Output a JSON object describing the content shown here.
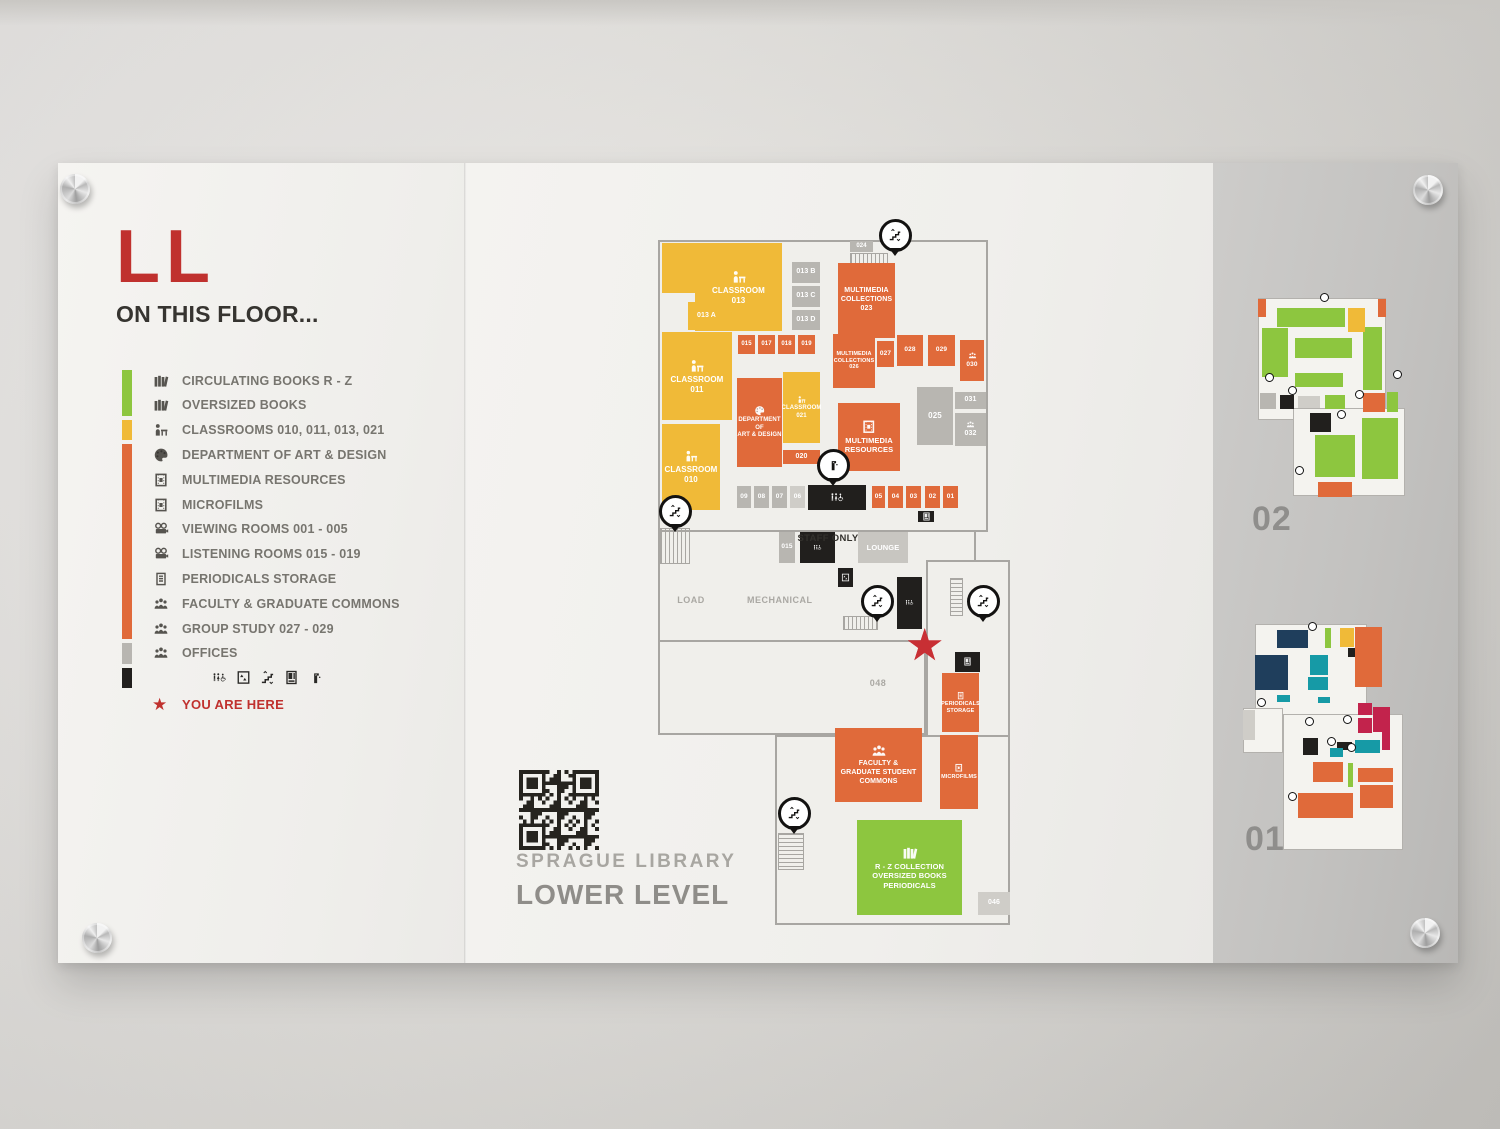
{
  "sign": {
    "floor_code": "LL",
    "heading": "ON THIS FLOOR...",
    "library_name": "SPRAGUE LIBRARY",
    "level_name": "LOWER LEVEL",
    "you_are_here": "YOU ARE HERE"
  },
  "colors": {
    "red": "#c0312e",
    "green": "#8dc63f",
    "yellow": "#f0ba38",
    "orange": "#e06a3a",
    "gray_room": "#b8b6b1",
    "gray_light": "#cfcdc8",
    "lounge": "#c8c6c1",
    "black": "#211f1d",
    "navy": "#1f3e5c",
    "teal": "#169aa6",
    "crimson": "#c2234c",
    "legend_green_rows": [
      0,
      1
    ],
    "legend_yellow_rows": [
      2,
      2
    ],
    "legend_orange_rows": [
      3,
      10
    ],
    "legend_gray_rows": [
      11,
      11
    ],
    "legend_black_rows": [
      12,
      12
    ]
  },
  "legend": [
    {
      "icon": "books",
      "label": "CIRCULATING BOOKS R - Z"
    },
    {
      "icon": "books",
      "label": "OVERSIZED BOOKS"
    },
    {
      "icon": "classroom",
      "label": "CLASSROOMS 010, 011, 013, 021"
    },
    {
      "icon": "palette",
      "label": "DEPARTMENT OF ART & DESIGN"
    },
    {
      "icon": "film",
      "label": "MULTIMEDIA RESOURCES"
    },
    {
      "icon": "film",
      "label": "MICROFILMS"
    },
    {
      "icon": "projector",
      "label": "VIEWING ROOMS 001 - 005"
    },
    {
      "icon": "projector",
      "label": "LISTENING ROOMS 015 - 019"
    },
    {
      "icon": "periodical",
      "label": "PERIODICALS STORAGE"
    },
    {
      "icon": "people",
      "label": "FACULTY & GRADUATE COMMONS"
    },
    {
      "icon": "people",
      "label": "GROUP STUDY 027 - 029"
    },
    {
      "icon": "people",
      "label": "OFFICES"
    }
  ],
  "amenities": [
    "restroom",
    "elevator",
    "stairs",
    "vending",
    "fountain"
  ],
  "map": {
    "plates": [
      {
        "x": 0,
        "y": 12,
        "w": 330,
        "h": 292
      },
      {
        "x": 0,
        "y": 302,
        "w": 318,
        "h": 112
      },
      {
        "x": 0,
        "y": 412,
        "w": 268,
        "h": 95
      },
      {
        "x": 117,
        "y": 507,
        "w": 235,
        "h": 190
      },
      {
        "x": 268,
        "y": 332,
        "w": 84,
        "h": 177
      }
    ],
    "stairs": [
      {
        "x": 192,
        "y": 25,
        "w": 38,
        "h": 14,
        "dir": "v"
      },
      {
        "x": 2,
        "y": 300,
        "w": 30,
        "h": 36,
        "dir": "v"
      },
      {
        "x": 185,
        "y": 388,
        "w": 35,
        "h": 14,
        "dir": "v"
      },
      {
        "x": 292,
        "y": 350,
        "w": 13,
        "h": 38,
        "dir": "h"
      },
      {
        "x": 120,
        "y": 605,
        "w": 26,
        "h": 37,
        "dir": "h"
      }
    ],
    "rooms": [
      {
        "x": 4,
        "y": 15,
        "w": 34,
        "h": 50,
        "c": "yellow",
        "lines": [],
        "fs": 7
      },
      {
        "x": 37,
        "y": 15,
        "w": 87,
        "h": 88,
        "c": "yellow",
        "icon": "classroom",
        "lines": [
          "CLASSROOM",
          "013"
        ],
        "fs": 8
      },
      {
        "x": 30,
        "y": 74,
        "w": 37,
        "h": 28,
        "c": "yellow",
        "lines": [
          "013 A"
        ],
        "fs": 7
      },
      {
        "x": 4,
        "y": 104,
        "w": 70,
        "h": 88,
        "c": "yellow",
        "icon": "classroom",
        "lines": [
          "CLASSROOM",
          "011"
        ],
        "fs": 8
      },
      {
        "x": 4,
        "y": 196,
        "w": 58,
        "h": 86,
        "c": "yellow",
        "icon": "classroom",
        "lines": [
          "CLASSROOM",
          "010"
        ],
        "fs": 8
      },
      {
        "x": 125,
        "y": 144,
        "w": 37,
        "h": 71,
        "c": "yellow",
        "icon": "classroom",
        "lines": [
          "CLASSROOM",
          "021"
        ],
        "fs": 6
      },
      {
        "x": 134,
        "y": 34,
        "w": 28,
        "h": 21,
        "c": "gray_room",
        "lines": [
          "013 B"
        ],
        "fs": 7
      },
      {
        "x": 134,
        "y": 58,
        "w": 28,
        "h": 21,
        "c": "gray_room",
        "lines": [
          "013 C"
        ],
        "fs": 7
      },
      {
        "x": 134,
        "y": 82,
        "w": 28,
        "h": 20,
        "c": "gray_room",
        "lines": [
          "013 D"
        ],
        "fs": 7
      },
      {
        "x": 192,
        "y": 13,
        "w": 23,
        "h": 11,
        "c": "gray_room",
        "lines": [
          "024"
        ],
        "fs": 6
      },
      {
        "x": 259,
        "y": 159,
        "w": 36,
        "h": 58,
        "c": "gray_room",
        "lines": [
          "025"
        ],
        "fs": 8
      },
      {
        "x": 297,
        "y": 164,
        "w": 31,
        "h": 17,
        "c": "gray_room",
        "lines": [
          "031"
        ],
        "fs": 7
      },
      {
        "x": 297,
        "y": 185,
        "w": 31,
        "h": 33,
        "c": "gray_room",
        "icon": "people",
        "lines": [
          "032"
        ],
        "fs": 7
      },
      {
        "x": 79,
        "y": 258,
        "w": 14,
        "h": 22,
        "c": "gray_room",
        "lines": [
          "09"
        ],
        "fs": 6.5
      },
      {
        "x": 96,
        "y": 258,
        "w": 15,
        "h": 22,
        "c": "gray_room",
        "lines": [
          "08"
        ],
        "fs": 6.5
      },
      {
        "x": 114,
        "y": 258,
        "w": 15,
        "h": 22,
        "c": "gray_room",
        "lines": [
          "07"
        ],
        "fs": 6.5
      },
      {
        "x": 132,
        "y": 258,
        "w": 15,
        "h": 22,
        "c": "gray_light",
        "lines": [
          "06"
        ],
        "fs": 6.5
      },
      {
        "x": 121,
        "y": 304,
        "w": 16,
        "h": 31,
        "c": "gray_room",
        "lines": [
          "015"
        ],
        "fs": 6.5
      },
      {
        "x": 200,
        "y": 304,
        "w": 50,
        "h": 31,
        "c": "lounge",
        "lines": [
          "LOUNGE"
        ],
        "fs": 7.5
      },
      {
        "x": 320,
        "y": 664,
        "w": 32,
        "h": 23,
        "c": "gray_light",
        "lines": [
          "046"
        ],
        "fs": 7
      },
      {
        "x": 180,
        "y": 35,
        "w": 57,
        "h": 75,
        "c": "orange",
        "lines": [
          "MULTIMEDIA",
          "COLLECTIONS",
          "023"
        ],
        "fs": 7
      },
      {
        "x": 80,
        "y": 107,
        "w": 17,
        "h": 19,
        "c": "orange",
        "lines": [
          "015"
        ],
        "fs": 6
      },
      {
        "x": 100,
        "y": 107,
        "w": 17,
        "h": 19,
        "c": "orange",
        "lines": [
          "017"
        ],
        "fs": 6
      },
      {
        "x": 120,
        "y": 107,
        "w": 17,
        "h": 19,
        "c": "orange",
        "lines": [
          "018"
        ],
        "fs": 6
      },
      {
        "x": 140,
        "y": 107,
        "w": 17,
        "h": 19,
        "c": "orange",
        "lines": [
          "019"
        ],
        "fs": 6
      },
      {
        "x": 175,
        "y": 106,
        "w": 42,
        "h": 54,
        "c": "orange",
        "lines": [
          "MULTIMEDIA",
          "COLLECTIONS",
          "026"
        ],
        "fs": 5.5
      },
      {
        "x": 219,
        "y": 113,
        "w": 17,
        "h": 26,
        "c": "orange",
        "lines": [
          "027"
        ],
        "fs": 6.5
      },
      {
        "x": 239,
        "y": 107,
        "w": 26,
        "h": 31,
        "c": "orange",
        "lines": [
          "028"
        ],
        "fs": 6.5
      },
      {
        "x": 270,
        "y": 107,
        "w": 27,
        "h": 31,
        "c": "orange",
        "lines": [
          "029"
        ],
        "fs": 6.5
      },
      {
        "x": 302,
        "y": 112,
        "w": 24,
        "h": 41,
        "c": "orange",
        "icon": "people",
        "lines": [
          "030"
        ],
        "fs": 6.5
      },
      {
        "x": 79,
        "y": 150,
        "w": 45,
        "h": 89,
        "c": "orange",
        "icon": "palette",
        "lines": [
          "DEPARTMENT",
          "OF",
          "ART & DESIGN"
        ],
        "fs": 6
      },
      {
        "x": 125,
        "y": 222,
        "w": 37,
        "h": 14,
        "c": "orange",
        "lines": [
          "020"
        ],
        "fs": 7
      },
      {
        "x": 180,
        "y": 175,
        "w": 62,
        "h": 68,
        "c": "orange",
        "icon": "film",
        "lines": [
          "MULTIMEDIA",
          "RESOURCES"
        ],
        "fs": 7.5
      },
      {
        "x": 214,
        "y": 258,
        "w": 13,
        "h": 22,
        "c": "orange",
        "lines": [
          "05"
        ],
        "fs": 6.5
      },
      {
        "x": 230,
        "y": 258,
        "w": 15,
        "h": 22,
        "c": "orange",
        "lines": [
          "04"
        ],
        "fs": 6.5
      },
      {
        "x": 248,
        "y": 258,
        "w": 15,
        "h": 22,
        "c": "orange",
        "lines": [
          "03"
        ],
        "fs": 6.5
      },
      {
        "x": 267,
        "y": 258,
        "w": 15,
        "h": 22,
        "c": "orange",
        "lines": [
          "02"
        ],
        "fs": 6.5
      },
      {
        "x": 285,
        "y": 258,
        "w": 15,
        "h": 22,
        "c": "orange",
        "lines": [
          "01"
        ],
        "fs": 6.5
      },
      {
        "x": 284,
        "y": 445,
        "w": 37,
        "h": 59,
        "c": "orange",
        "icon": "periodical",
        "lines": [
          "PERIODICALS",
          "STORAGE"
        ],
        "fs": 5.5
      },
      {
        "x": 282,
        "y": 507,
        "w": 38,
        "h": 74,
        "c": "orange",
        "icon": "film",
        "lines": [
          "MICROFILMS"
        ],
        "fs": 5.5
      },
      {
        "x": 177,
        "y": 500,
        "w": 87,
        "h": 74,
        "c": "orange",
        "icon": "people",
        "lines": [
          "FACULTY &",
          "GRADUATE STUDENT",
          "COMMONS"
        ],
        "fs": 7
      },
      {
        "x": 199,
        "y": 592,
        "w": 105,
        "h": 95,
        "c": "green",
        "icon": "books",
        "lines": [
          "R - Z COLLECTION",
          "OVERSIZED BOOKS",
          "PERIODICALS"
        ],
        "fs": 7.5
      },
      {
        "x": 150,
        "y": 257,
        "w": 58,
        "h": 25,
        "c": "black",
        "icon": "restroom",
        "lines": [],
        "fs": 7
      },
      {
        "x": 142,
        "y": 304,
        "w": 35,
        "h": 31,
        "c": "black",
        "icon": "restroom",
        "lines": [],
        "fs": 7
      },
      {
        "x": 239,
        "y": 349,
        "w": 25,
        "h": 52,
        "c": "black",
        "icon": "restroom",
        "lines": [],
        "fs": 7
      },
      {
        "x": 180,
        "y": 340,
        "w": 15,
        "h": 19,
        "c": "black",
        "icon": "elevator",
        "lines": [],
        "fs": 7
      },
      {
        "x": 260,
        "y": 283,
        "w": 16,
        "h": 11,
        "c": "black",
        "icon": "vending",
        "lines": [],
        "fs": 7
      },
      {
        "x": 297,
        "y": 424,
        "w": 25,
        "h": 20,
        "c": "black",
        "icon": "vending",
        "lines": [],
        "fs": 7
      }
    ],
    "labels": [
      {
        "x": 139,
        "y": 305,
        "w": 62,
        "text": "STAFF ONLY",
        "cls": "dark"
      },
      {
        "x": 13,
        "y": 367,
        "w": 40,
        "text": "LOAD",
        "cls": "faint"
      },
      {
        "x": 89,
        "y": 367,
        "w": 62,
        "text": "MECHANICAL",
        "cls": "faint"
      },
      {
        "x": 195,
        "y": 450,
        "w": 50,
        "text": "048",
        "cls": "faint"
      }
    ],
    "pins": [
      {
        "x": 234,
        "y": 4,
        "icon": "stairs"
      },
      {
        "x": 172,
        "y": 234,
        "icon": "fountain"
      },
      {
        "x": 14,
        "y": 280,
        "icon": "stairs"
      },
      {
        "x": 216,
        "y": 370,
        "icon": "stairs"
      },
      {
        "x": 322,
        "y": 370,
        "icon": "stairs"
      },
      {
        "x": 133,
        "y": 582,
        "icon": "stairs"
      }
    ],
    "star": {
      "x": 268,
      "y": 418
    }
  },
  "minimaps": [
    {
      "label": "02",
      "pos": {
        "x": 1200,
        "y": 130,
        "w": 150,
        "h": 210
      },
      "label_pos": {
        "x": 1194,
        "y": 337
      },
      "plates": [
        {
          "x": 0,
          "y": 5,
          "w": 128,
          "h": 122
        },
        {
          "x": 35,
          "y": 115,
          "w": 112,
          "h": 88
        }
      ],
      "blocks": [
        {
          "x": 19,
          "y": 15,
          "w": 68,
          "h": 19,
          "c": "green"
        },
        {
          "x": 4,
          "y": 35,
          "w": 26,
          "h": 49,
          "c": "green"
        },
        {
          "x": 37,
          "y": 45,
          "w": 57,
          "h": 20,
          "c": "green"
        },
        {
          "x": 105,
          "y": 34,
          "w": 19,
          "h": 63,
          "c": "green"
        },
        {
          "x": 37,
          "y": 80,
          "w": 48,
          "h": 14,
          "c": "green"
        },
        {
          "x": 90,
          "y": 15,
          "w": 17,
          "h": 24,
          "c": "yellow"
        },
        {
          "x": 0,
          "y": 6,
          "w": 8,
          "h": 18,
          "c": "orange"
        },
        {
          "x": 120,
          "y": 6,
          "w": 8,
          "h": 18,
          "c": "orange"
        },
        {
          "x": 2,
          "y": 100,
          "w": 16,
          "h": 16,
          "c": "gray_room"
        },
        {
          "x": 22,
          "y": 102,
          "w": 14,
          "h": 14,
          "c": "black"
        },
        {
          "x": 40,
          "y": 103,
          "w": 22,
          "h": 12,
          "c": "gray_light"
        },
        {
          "x": 67,
          "y": 102,
          "w": 20,
          "h": 14,
          "c": "green"
        },
        {
          "x": 105,
          "y": 100,
          "w": 22,
          "h": 19,
          "c": "orange"
        },
        {
          "x": 129,
          "y": 99,
          "w": 11,
          "h": 20,
          "c": "green"
        },
        {
          "x": 52,
          "y": 120,
          "w": 21,
          "h": 19,
          "c": "black"
        },
        {
          "x": 57,
          "y": 142,
          "w": 40,
          "h": 42,
          "c": "green"
        },
        {
          "x": 104,
          "y": 125,
          "w": 36,
          "h": 61,
          "c": "green"
        },
        {
          "x": 60,
          "y": 189,
          "w": 34,
          "h": 15,
          "c": "orange"
        }
      ],
      "pins": [
        {
          "x": 62,
          "y": 0
        },
        {
          "x": 7,
          "y": 80
        },
        {
          "x": 30,
          "y": 93
        },
        {
          "x": 97,
          "y": 97
        },
        {
          "x": 135,
          "y": 77
        },
        {
          "x": 79,
          "y": 117
        },
        {
          "x": 37,
          "y": 173
        }
      ]
    },
    {
      "label": "01",
      "pos": {
        "x": 1185,
        "y": 455,
        "w": 160,
        "h": 232
      },
      "label_pos": {
        "x": 1187,
        "y": 657
      },
      "plates": [
        {
          "x": 12,
          "y": 6,
          "w": 112,
          "h": 124
        },
        {
          "x": 40,
          "y": 96,
          "w": 120,
          "h": 136
        },
        {
          "x": 0,
          "y": 90,
          "w": 40,
          "h": 45
        }
      ],
      "blocks": [
        {
          "x": 34,
          "y": 12,
          "w": 31,
          "h": 18,
          "c": "navy"
        },
        {
          "x": 12,
          "y": 37,
          "w": 33,
          "h": 35,
          "c": "navy"
        },
        {
          "x": 67,
          "y": 37,
          "w": 18,
          "h": 20,
          "c": "teal"
        },
        {
          "x": 65,
          "y": 59,
          "w": 20,
          "h": 13,
          "c": "teal"
        },
        {
          "x": 82,
          "y": 10,
          "w": 6,
          "h": 20,
          "c": "green"
        },
        {
          "x": 97,
          "y": 10,
          "w": 14,
          "h": 19,
          "c": "yellow"
        },
        {
          "x": 105,
          "y": 30,
          "w": 7,
          "h": 9,
          "c": "black"
        },
        {
          "x": 112,
          "y": 9,
          "w": 27,
          "h": 60,
          "c": "orange"
        },
        {
          "x": 34,
          "y": 77,
          "w": 13,
          "h": 7,
          "c": "teal"
        },
        {
          "x": 75,
          "y": 79,
          "w": 12,
          "h": 6,
          "c": "teal"
        },
        {
          "x": 115,
          "y": 85,
          "w": 14,
          "h": 12,
          "c": "crimson"
        },
        {
          "x": 130,
          "y": 89,
          "w": 17,
          "h": 25,
          "c": "crimson"
        },
        {
          "x": 115,
          "y": 100,
          "w": 14,
          "h": 15,
          "c": "crimson"
        },
        {
          "x": 139,
          "y": 112,
          "w": 8,
          "h": 20,
          "c": "crimson"
        },
        {
          "x": 60,
          "y": 120,
          "w": 15,
          "h": 17,
          "c": "black"
        },
        {
          "x": 94,
          "y": 124,
          "w": 15,
          "h": 8,
          "c": "black"
        },
        {
          "x": 112,
          "y": 122,
          "w": 25,
          "h": 13,
          "c": "teal"
        },
        {
          "x": 87,
          "y": 130,
          "w": 13,
          "h": 9,
          "c": "teal"
        },
        {
          "x": 70,
          "y": 144,
          "w": 30,
          "h": 20,
          "c": "orange"
        },
        {
          "x": 105,
          "y": 145,
          "w": 5,
          "h": 24,
          "c": "green"
        },
        {
          "x": 115,
          "y": 150,
          "w": 35,
          "h": 14,
          "c": "orange"
        },
        {
          "x": 117,
          "y": 167,
          "w": 33,
          "h": 23,
          "c": "orange"
        },
        {
          "x": 55,
          "y": 175,
          "w": 55,
          "h": 25,
          "c": "orange"
        },
        {
          "x": 0,
          "y": 92,
          "w": 12,
          "h": 30,
          "c": "gray_light"
        }
      ],
      "pins": [
        {
          "x": 65,
          "y": 4
        },
        {
          "x": 14,
          "y": 80
        },
        {
          "x": 62,
          "y": 99
        },
        {
          "x": 100,
          "y": 97
        },
        {
          "x": 84,
          "y": 119
        },
        {
          "x": 104,
          "y": 125
        },
        {
          "x": 45,
          "y": 174
        }
      ]
    }
  ]
}
